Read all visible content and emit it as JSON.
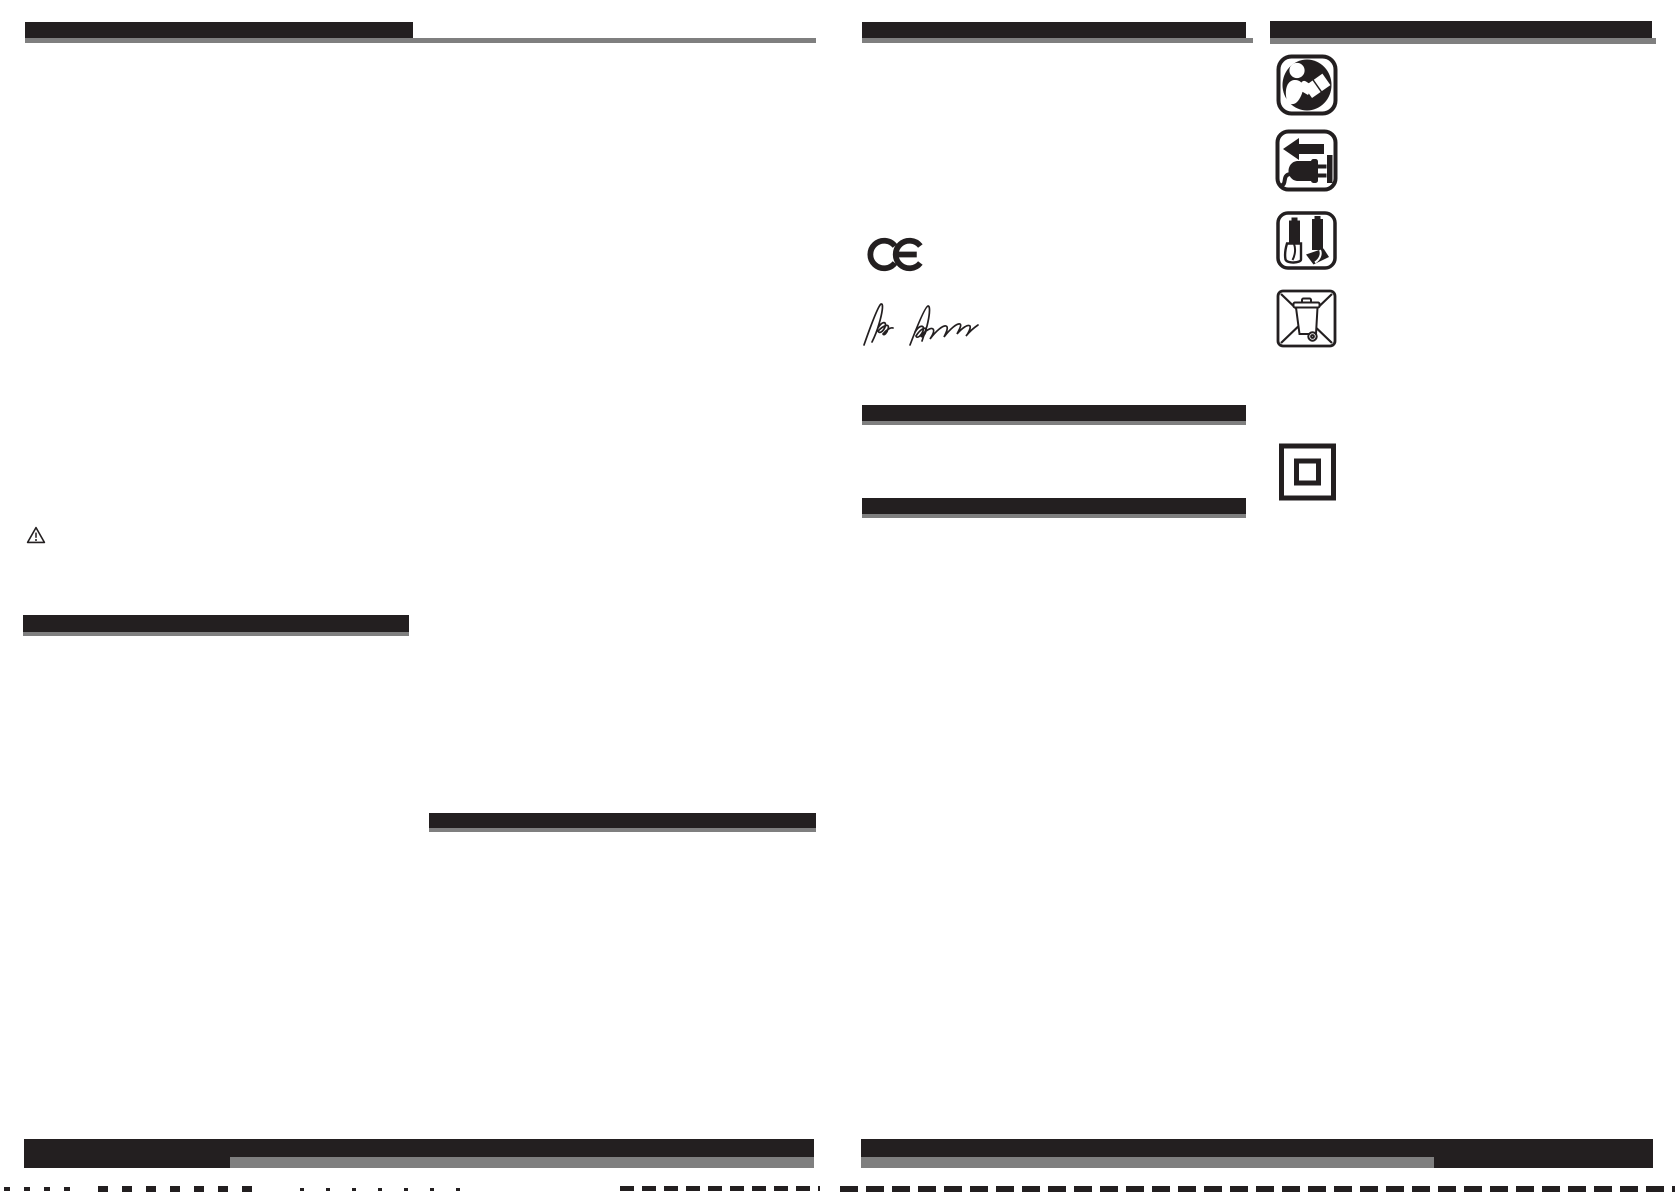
{
  "colors": {
    "ink": "#231f20",
    "gray": "#7f7f7f",
    "paper": "#ffffff"
  },
  "document": {
    "kind": "instruction-manual-spread",
    "pages": 2,
    "note": "Section heading bars are solid black (no legible text); body areas are blank"
  },
  "ce_mark": {
    "label": "CE"
  },
  "signature": {
    "title": "signature"
  },
  "symbols": {
    "warning_triangle": "warning-triangle",
    "read_manual": "read-manual-symbol",
    "unplug": "disconnect-plug-symbol",
    "battery": "battery-insertion-symbol",
    "weee": "crossed-out-wheeled-bin-symbol",
    "double_insulation": "double-insulation-class2-symbol"
  }
}
